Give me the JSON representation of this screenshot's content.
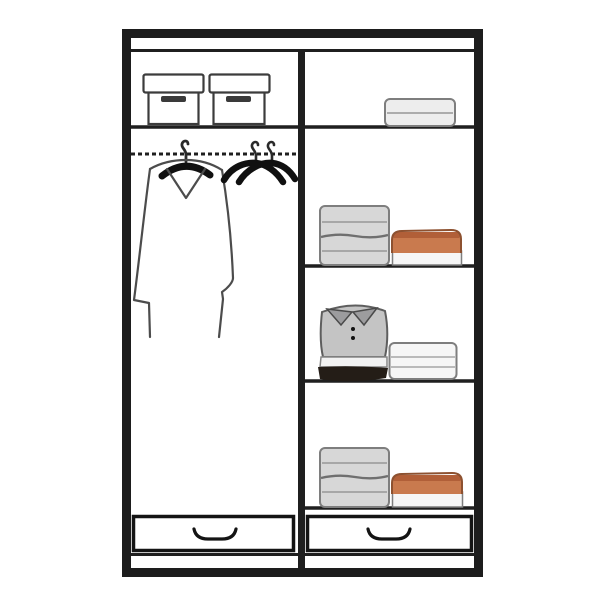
{
  "meta": {
    "title": "Wardrobe interior organization diagram",
    "canvas": {
      "width": 600,
      "height": 600
    }
  },
  "colors": {
    "background": "#ffffff",
    "frame": "#1d1d1d",
    "shelf_line": "#1f1f1f",
    "item_outline": "#7e7e7e",
    "coat_outline": "#4c4c4c",
    "hanger_black": "#101010",
    "gray_fill": "#d7d7d7",
    "white_fill": "#f6f6f6",
    "light_fill": "#ededed",
    "orange_fill": "#c97a4e",
    "orange_dark": "#b15f38",
    "polo_body": "#c4c4c4",
    "polo_collar": "#9c9c9e",
    "dark_layer": "#241d17",
    "box_slot": "#3a3a3a"
  },
  "wardrobe": {
    "columns": 2,
    "left_column": {
      "top_shelf": {
        "items": [
          {
            "type": "storage-box",
            "lid": true,
            "label_slot": true
          },
          {
            "type": "storage-box",
            "lid": true,
            "label_slot": true
          }
        ]
      },
      "hanging_section": {
        "rod_style": "dashed",
        "items": [
          {
            "type": "long-coat-on-hanger",
            "color": "white-outline"
          },
          {
            "type": "empty-hanger",
            "color": "black"
          },
          {
            "type": "empty-hanger",
            "color": "black"
          }
        ]
      },
      "drawer": {
        "count": 1,
        "handle": "recessed-curve"
      }
    },
    "right_column": {
      "shelves": [
        {
          "position": "top",
          "items": [
            {
              "type": "folded-stack",
              "color": "white",
              "layers": 2
            }
          ]
        },
        {
          "position": "second",
          "items": [
            {
              "type": "folded-stack",
              "color": "gray",
              "layers": 2
            },
            {
              "type": "folded-stack",
              "color": "orange-on-white",
              "layers": 2
            }
          ]
        },
        {
          "position": "third",
          "items": [
            {
              "type": "folded-polo-shirt-stack",
              "color": "gray-white-black",
              "buttons": 2
            },
            {
              "type": "folded-stack",
              "color": "white",
              "layers": 2
            }
          ]
        },
        {
          "position": "bottom",
          "items": [
            {
              "type": "folded-stack",
              "color": "gray",
              "layers": 2
            },
            {
              "type": "folded-stack",
              "color": "orange-on-white",
              "layers": 2
            }
          ]
        }
      ],
      "drawer": {
        "count": 1,
        "handle": "recessed-curve"
      }
    },
    "base": {
      "plinth": true
    }
  }
}
